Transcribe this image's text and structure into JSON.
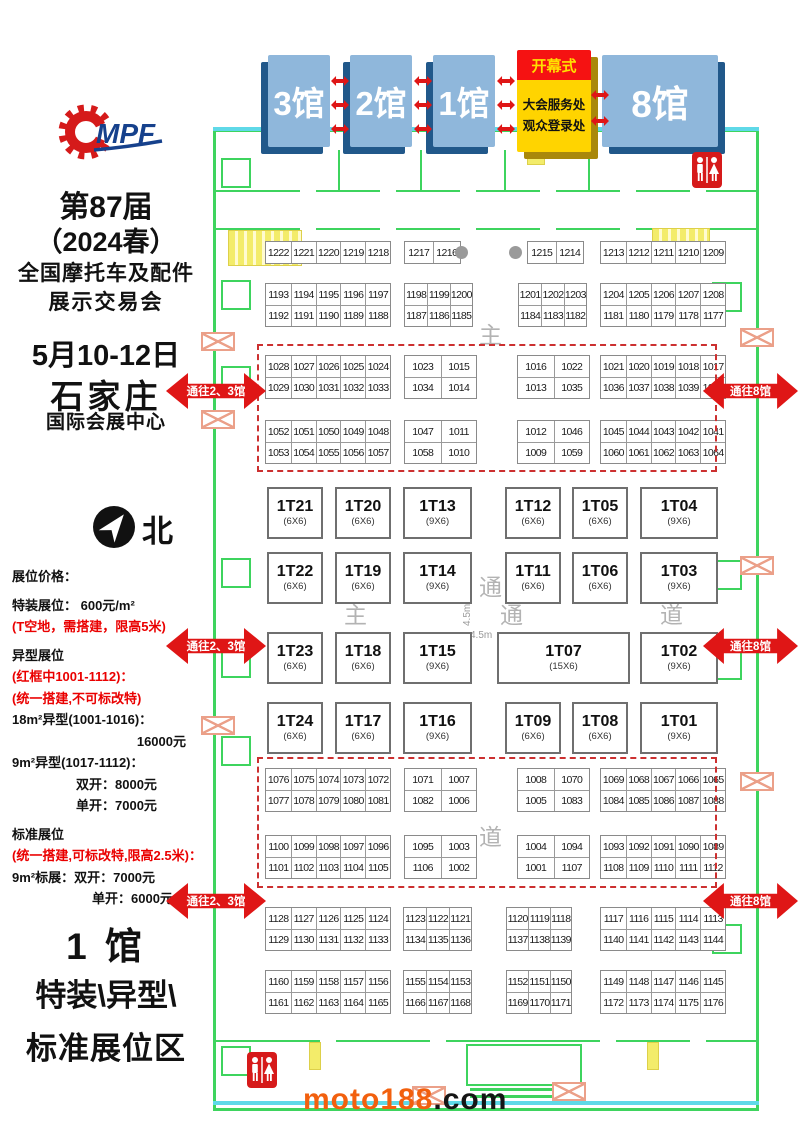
{
  "header": {
    "halls": [
      {
        "label": "3馆"
      },
      {
        "label": "2馆"
      },
      {
        "label": "1馆"
      },
      {
        "label": "8馆"
      }
    ],
    "service_box": {
      "banner": "开幕式",
      "lines": [
        "大会服务处",
        "观众登录处"
      ]
    },
    "mini_arrow_clusters": [
      {
        "x": 331,
        "ys": [
          76,
          100,
          124
        ]
      },
      {
        "x": 414,
        "ys": [
          76,
          100,
          124
        ]
      },
      {
        "x": 497,
        "ys": [
          76,
          100,
          124
        ]
      },
      {
        "x": 591,
        "ys": [
          90,
          116
        ]
      }
    ]
  },
  "sidebar": {
    "logo_text": "MPF",
    "title_lines": [
      "第87届",
      "（2024春）",
      "全国摩托车及配件",
      "展示交易会"
    ],
    "date_lines": [
      "5月10-12日",
      "石家庄",
      "国际会展中心"
    ],
    "compass_label": "北",
    "pricing_lines": [
      {
        "text": "展位价格：",
        "red": false,
        "align": "left",
        "gap": false
      },
      {
        "text": "特装展位： 600元/m²",
        "red": false,
        "align": "left",
        "gap": true
      },
      {
        "text": "(T空地，需搭建，限高5米)",
        "red": true,
        "align": "left",
        "gap": false
      },
      {
        "text": "异型展位",
        "red": false,
        "align": "left",
        "gap": true
      },
      {
        "text": "(红框中1001-1112)：",
        "red": true,
        "align": "left",
        "gap": false
      },
      {
        "text": "(统一搭建,不可标改特)",
        "red": true,
        "align": "left",
        "gap": false
      },
      {
        "text": "18m²异型(1001-1016)：",
        "red": false,
        "align": "left",
        "gap": false
      },
      {
        "text": "16000元",
        "red": false,
        "align": "right",
        "gap": false
      },
      {
        "text": "9m²异型(1017-1112)：",
        "red": false,
        "align": "left",
        "gap": false
      },
      {
        "text": "双开：8000元",
        "red": false,
        "align": "mid",
        "gap": false
      },
      {
        "text": "单开：7000元",
        "red": false,
        "align": "mid",
        "gap": false
      },
      {
        "text": "标准展位",
        "red": false,
        "align": "left",
        "gap": true
      },
      {
        "text": "(统一搭建,可标改特,限高2.5米)：",
        "red": true,
        "align": "left",
        "gap": false
      },
      {
        "text": "9m²标展：双开：7000元",
        "red": false,
        "align": "left",
        "gap": false
      },
      {
        "text": "单开：6000元",
        "red": false,
        "align": "mid2",
        "gap": false
      }
    ],
    "hall_zone_lines": [
      "1 馆",
      "特装\\异型\\",
      "标准展位区"
    ]
  },
  "floorplan": {
    "booth_blocks": [
      {
        "x": 265,
        "y": 241,
        "w": 126,
        "rows": [
          [
            "1222",
            "1221",
            "1220",
            "1219",
            "1218"
          ]
        ]
      },
      {
        "x": 404,
        "y": 241,
        "w": 57,
        "rows": [
          [
            "1217",
            "1216"
          ]
        ]
      },
      {
        "x": 527,
        "y": 241,
        "w": 57,
        "rows": [
          [
            "1215",
            "1214"
          ]
        ]
      },
      {
        "x": 600,
        "y": 241,
        "w": 126,
        "rows": [
          [
            "1213",
            "1212",
            "1211",
            "1210",
            "1209"
          ]
        ]
      },
      {
        "x": 265,
        "y": 283,
        "w": 126,
        "rows": [
          [
            "1193",
            "1194",
            "1195",
            "1196",
            "1197"
          ],
          [
            "1192",
            "1191",
            "1190",
            "1189",
            "1188"
          ]
        ]
      },
      {
        "x": 404,
        "y": 283,
        "w": 69,
        "rows": [
          [
            "1198",
            "1199",
            "1200"
          ],
          [
            "1187",
            "1186",
            "1185"
          ]
        ]
      },
      {
        "x": 518,
        "y": 283,
        "w": 69,
        "rows": [
          [
            "1201",
            "1202",
            "1203"
          ],
          [
            "1184",
            "1183",
            "1182"
          ]
        ]
      },
      {
        "x": 600,
        "y": 283,
        "w": 126,
        "rows": [
          [
            "1204",
            "1205",
            "1206",
            "1207",
            "1208"
          ],
          [
            "1181",
            "1180",
            "1179",
            "1178",
            "1177"
          ]
        ]
      },
      {
        "x": 265,
        "y": 355,
        "w": 126,
        "rows": [
          [
            "1028",
            "1027",
            "1026",
            "1025",
            "1024"
          ],
          [
            "1029",
            "1030",
            "1031",
            "1032",
            "1033"
          ]
        ]
      },
      {
        "x": 404,
        "y": 355,
        "w": 73,
        "rows": [
          [
            "1023",
            "1015"
          ],
          [
            "1034",
            "1014"
          ]
        ]
      },
      {
        "x": 517,
        "y": 355,
        "w": 73,
        "rows": [
          [
            "1016",
            "1022"
          ],
          [
            "1013",
            "1035"
          ]
        ]
      },
      {
        "x": 600,
        "y": 355,
        "w": 126,
        "rows": [
          [
            "1021",
            "1020",
            "1019",
            "1018",
            "1017"
          ],
          [
            "1036",
            "1037",
            "1038",
            "1039",
            "1040"
          ]
        ]
      },
      {
        "x": 265,
        "y": 420,
        "w": 126,
        "rows": [
          [
            "1052",
            "1051",
            "1050",
            "1049",
            "1048"
          ],
          [
            "1053",
            "1054",
            "1055",
            "1056",
            "1057"
          ]
        ]
      },
      {
        "x": 404,
        "y": 420,
        "w": 73,
        "rows": [
          [
            "1047",
            "1011"
          ],
          [
            "1058",
            "1010"
          ]
        ]
      },
      {
        "x": 517,
        "y": 420,
        "w": 73,
        "rows": [
          [
            "1012",
            "1046"
          ],
          [
            "1009",
            "1059"
          ]
        ]
      },
      {
        "x": 600,
        "y": 420,
        "w": 126,
        "rows": [
          [
            "1045",
            "1044",
            "1043",
            "1042",
            "1041"
          ],
          [
            "1060",
            "1061",
            "1062",
            "1063",
            "1064"
          ]
        ]
      },
      {
        "x": 265,
        "y": 768,
        "w": 126,
        "rows": [
          [
            "1076",
            "1075",
            "1074",
            "1073",
            "1072"
          ],
          [
            "1077",
            "1078",
            "1079",
            "1080",
            "1081"
          ]
        ]
      },
      {
        "x": 404,
        "y": 768,
        "w": 73,
        "rows": [
          [
            "1071",
            "1007"
          ],
          [
            "1082",
            "1006"
          ]
        ]
      },
      {
        "x": 517,
        "y": 768,
        "w": 73,
        "rows": [
          [
            "1008",
            "1070"
          ],
          [
            "1005",
            "1083"
          ]
        ]
      },
      {
        "x": 600,
        "y": 768,
        "w": 126,
        "rows": [
          [
            "1069",
            "1068",
            "1067",
            "1066",
            "1065"
          ],
          [
            "1084",
            "1085",
            "1086",
            "1087",
            "1088"
          ]
        ]
      },
      {
        "x": 265,
        "y": 835,
        "w": 126,
        "rows": [
          [
            "1100",
            "1099",
            "1098",
            "1097",
            "1096"
          ],
          [
            "1101",
            "1102",
            "1103",
            "1104",
            "1105"
          ]
        ]
      },
      {
        "x": 404,
        "y": 835,
        "w": 73,
        "rows": [
          [
            "1095",
            "1003"
          ],
          [
            "1106",
            "1002"
          ]
        ]
      },
      {
        "x": 517,
        "y": 835,
        "w": 73,
        "rows": [
          [
            "1004",
            "1094"
          ],
          [
            "1001",
            "1107"
          ]
        ]
      },
      {
        "x": 600,
        "y": 835,
        "w": 126,
        "rows": [
          [
            "1093",
            "1092",
            "1091",
            "1090",
            "1089"
          ],
          [
            "1108",
            "1109",
            "1110",
            "1111",
            "1112"
          ]
        ]
      },
      {
        "x": 265,
        "y": 907,
        "w": 126,
        "rows": [
          [
            "1128",
            "1127",
            "1126",
            "1125",
            "1124"
          ],
          [
            "1129",
            "1130",
            "1131",
            "1132",
            "1133"
          ]
        ]
      },
      {
        "x": 403,
        "y": 907,
        "w": 69,
        "rows": [
          [
            "1123",
            "1122",
            "1121"
          ],
          [
            "1134",
            "1135",
            "1136"
          ]
        ]
      },
      {
        "x": 506,
        "y": 907,
        "w": 66,
        "rows": [
          [
            "1120",
            "1119",
            "1118"
          ],
          [
            "1137",
            "1138",
            "1139"
          ]
        ]
      },
      {
        "x": 600,
        "y": 907,
        "w": 126,
        "rows": [
          [
            "1117",
            "1116",
            "1115",
            "1114",
            "1113"
          ],
          [
            "1140",
            "1141",
            "1142",
            "1143",
            "1144"
          ]
        ]
      },
      {
        "x": 265,
        "y": 970,
        "w": 126,
        "rows": [
          [
            "1160",
            "1159",
            "1158",
            "1157",
            "1156"
          ],
          [
            "1161",
            "1162",
            "1163",
            "1164",
            "1165"
          ]
        ]
      },
      {
        "x": 403,
        "y": 970,
        "w": 69,
        "rows": [
          [
            "1155",
            "1154",
            "1153"
          ],
          [
            "1166",
            "1167",
            "1168"
          ]
        ]
      },
      {
        "x": 506,
        "y": 970,
        "w": 66,
        "rows": [
          [
            "1152",
            "1151",
            "1150"
          ],
          [
            "1169",
            "1170",
            "1171"
          ]
        ]
      },
      {
        "x": 600,
        "y": 970,
        "w": 126,
        "rows": [
          [
            "1149",
            "1148",
            "1147",
            "1146",
            "1145"
          ],
          [
            "1172",
            "1173",
            "1174",
            "1175",
            "1176"
          ]
        ]
      }
    ],
    "t_rows": [
      {
        "y": 487,
        "items": [
          {
            "x": 267,
            "w": 56,
            "label": "1T21",
            "size": "(6X6)"
          },
          {
            "x": 335,
            "w": 56,
            "label": "1T20",
            "size": "(6X6)"
          },
          {
            "x": 403,
            "w": 69,
            "label": "1T13",
            "size": "(9X6)"
          },
          {
            "x": 505,
            "w": 56,
            "label": "1T12",
            "size": "(6X6)"
          },
          {
            "x": 572,
            "w": 56,
            "label": "1T05",
            "size": "(6X6)"
          },
          {
            "x": 640,
            "w": 78,
            "label": "1T04",
            "size": "(9X6)"
          }
        ]
      },
      {
        "y": 552,
        "items": [
          {
            "x": 267,
            "w": 56,
            "label": "1T22",
            "size": "(6X6)"
          },
          {
            "x": 335,
            "w": 56,
            "label": "1T19",
            "size": "(6X6)"
          },
          {
            "x": 403,
            "w": 69,
            "label": "1T14",
            "size": "(9X6)"
          },
          {
            "x": 505,
            "w": 56,
            "label": "1T11",
            "size": "(6X6)"
          },
          {
            "x": 572,
            "w": 56,
            "label": "1T06",
            "size": "(6X6)"
          },
          {
            "x": 640,
            "w": 78,
            "label": "1T03",
            "size": "(9X6)"
          }
        ]
      },
      {
        "y": 632,
        "items": [
          {
            "x": 267,
            "w": 56,
            "label": "1T23",
            "size": "(6X6)"
          },
          {
            "x": 335,
            "w": 56,
            "label": "1T18",
            "size": "(6X6)"
          },
          {
            "x": 403,
            "w": 69,
            "label": "1T15",
            "size": "(9X6)"
          },
          {
            "x": 497,
            "w": 133,
            "label": "1T07",
            "size": "(15X6)"
          },
          {
            "x": 640,
            "w": 78,
            "label": "1T02",
            "size": "(9X6)"
          }
        ]
      },
      {
        "y": 702,
        "items": [
          {
            "x": 267,
            "w": 56,
            "label": "1T24",
            "size": "(6X6)"
          },
          {
            "x": 335,
            "w": 56,
            "label": "1T17",
            "size": "(6X6)"
          },
          {
            "x": 403,
            "w": 69,
            "label": "1T16",
            "size": "(9X6)"
          },
          {
            "x": 505,
            "w": 56,
            "label": "1T09",
            "size": "(6X6)"
          },
          {
            "x": 572,
            "w": 56,
            "label": "1T08",
            "size": "(6X6)"
          },
          {
            "x": 640,
            "w": 78,
            "label": "1T01",
            "size": "(9X6)"
          }
        ]
      }
    ],
    "red_boxes": [
      {
        "x": 257,
        "y": 344,
        "w": 460,
        "h": 128
      },
      {
        "x": 257,
        "y": 757,
        "w": 460,
        "h": 131
      }
    ],
    "arrows": [
      {
        "x": 166,
        "y": 373,
        "w": 100,
        "label": "通往2、3馆"
      },
      {
        "x": 166,
        "y": 628,
        "w": 100,
        "label": "通往2、3馆"
      },
      {
        "x": 166,
        "y": 883,
        "w": 100,
        "label": "通往2、3馆"
      },
      {
        "x": 703,
        "y": 373,
        "w": 95,
        "label": "通往8馆"
      },
      {
        "x": 703,
        "y": 628,
        "w": 95,
        "label": "通往8馆"
      },
      {
        "x": 703,
        "y": 883,
        "w": 95,
        "label": "通往8馆"
      }
    ],
    "aisle_chars": [
      {
        "t": "主",
        "x": 479,
        "y": 316
      },
      {
        "t": "通",
        "x": 479,
        "y": 568
      },
      {
        "t": "道",
        "x": 479,
        "y": 818
      },
      {
        "t": "主",
        "x": 344,
        "y": 596
      },
      {
        "t": "通",
        "x": 500,
        "y": 596
      },
      {
        "t": "道",
        "x": 660,
        "y": 596
      }
    ],
    "measure_labels": [
      {
        "t": "4.5m",
        "x": 462,
        "y": 626,
        "rot": true
      },
      {
        "t": "4.5m",
        "x": 470,
        "y": 630,
        "rot": false
      }
    ],
    "pillar_dots": [
      {
        "x": 455,
        "y": 246
      },
      {
        "x": 509,
        "y": 246
      }
    ],
    "watermark": {
      "left": "moto188",
      "right": ".com"
    }
  }
}
